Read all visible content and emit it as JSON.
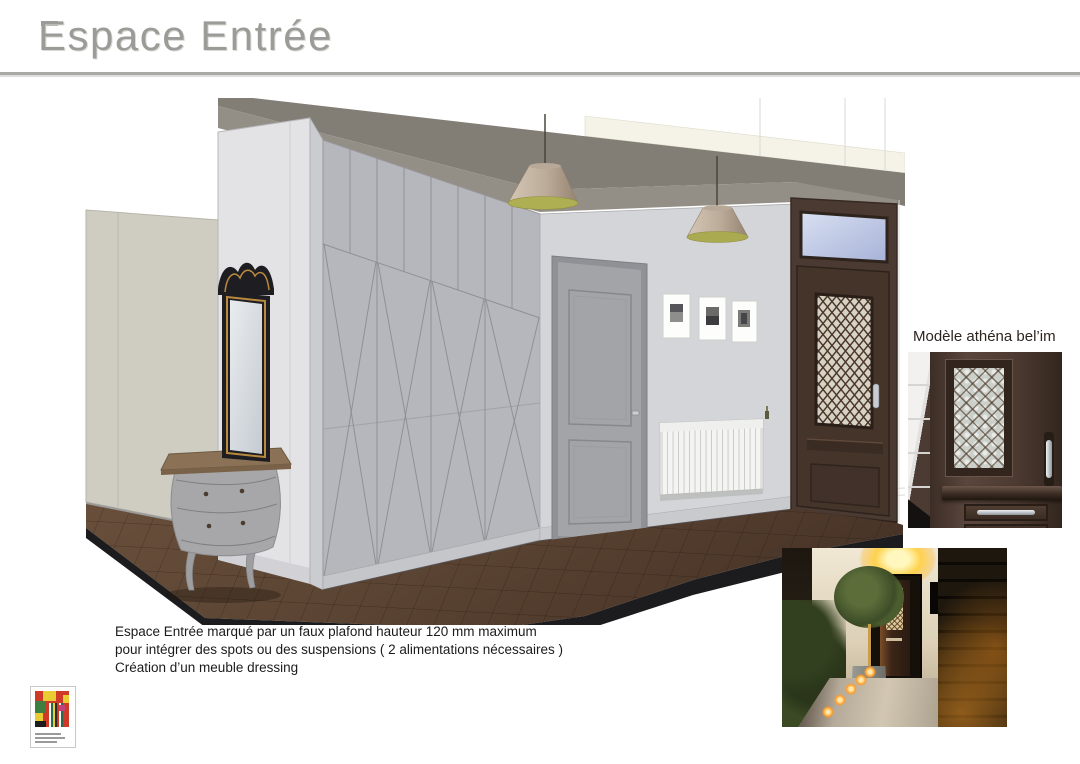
{
  "header": {
    "title": "Espace Entrée"
  },
  "door_model": {
    "label": "Modèle athéna bel’im"
  },
  "annotation": {
    "line1": "Espace Entrée marqué par un faux plafond hauteur 120 mm maximum",
    "line2": "pour intégrer des spots ou des suspensions ( 2 alimentations nécessaires )",
    "line3": "Création d’un meuble dressing"
  },
  "render": {
    "objects": [
      "faux-plafond",
      "suspension",
      "dressing",
      "miroir",
      "commode",
      "porte-interieure",
      "cadres",
      "radiateur",
      "porte-entree",
      "sol-carrelage"
    ]
  },
  "colors": {
    "title_gray": "#9b9b97",
    "rule_gray": "#a9a9a5",
    "faux_plafond": "#847f77",
    "wall_light": "#d4d5d9",
    "wardrobe_gray": "#b6b7bd",
    "front_door_brown": "#46362c",
    "lamp_shade": "#c6b6a5",
    "lamp_inner_olive": "#aeae52",
    "floor_brown": "#5b4433",
    "annotation_text": "#1b1b1b"
  }
}
